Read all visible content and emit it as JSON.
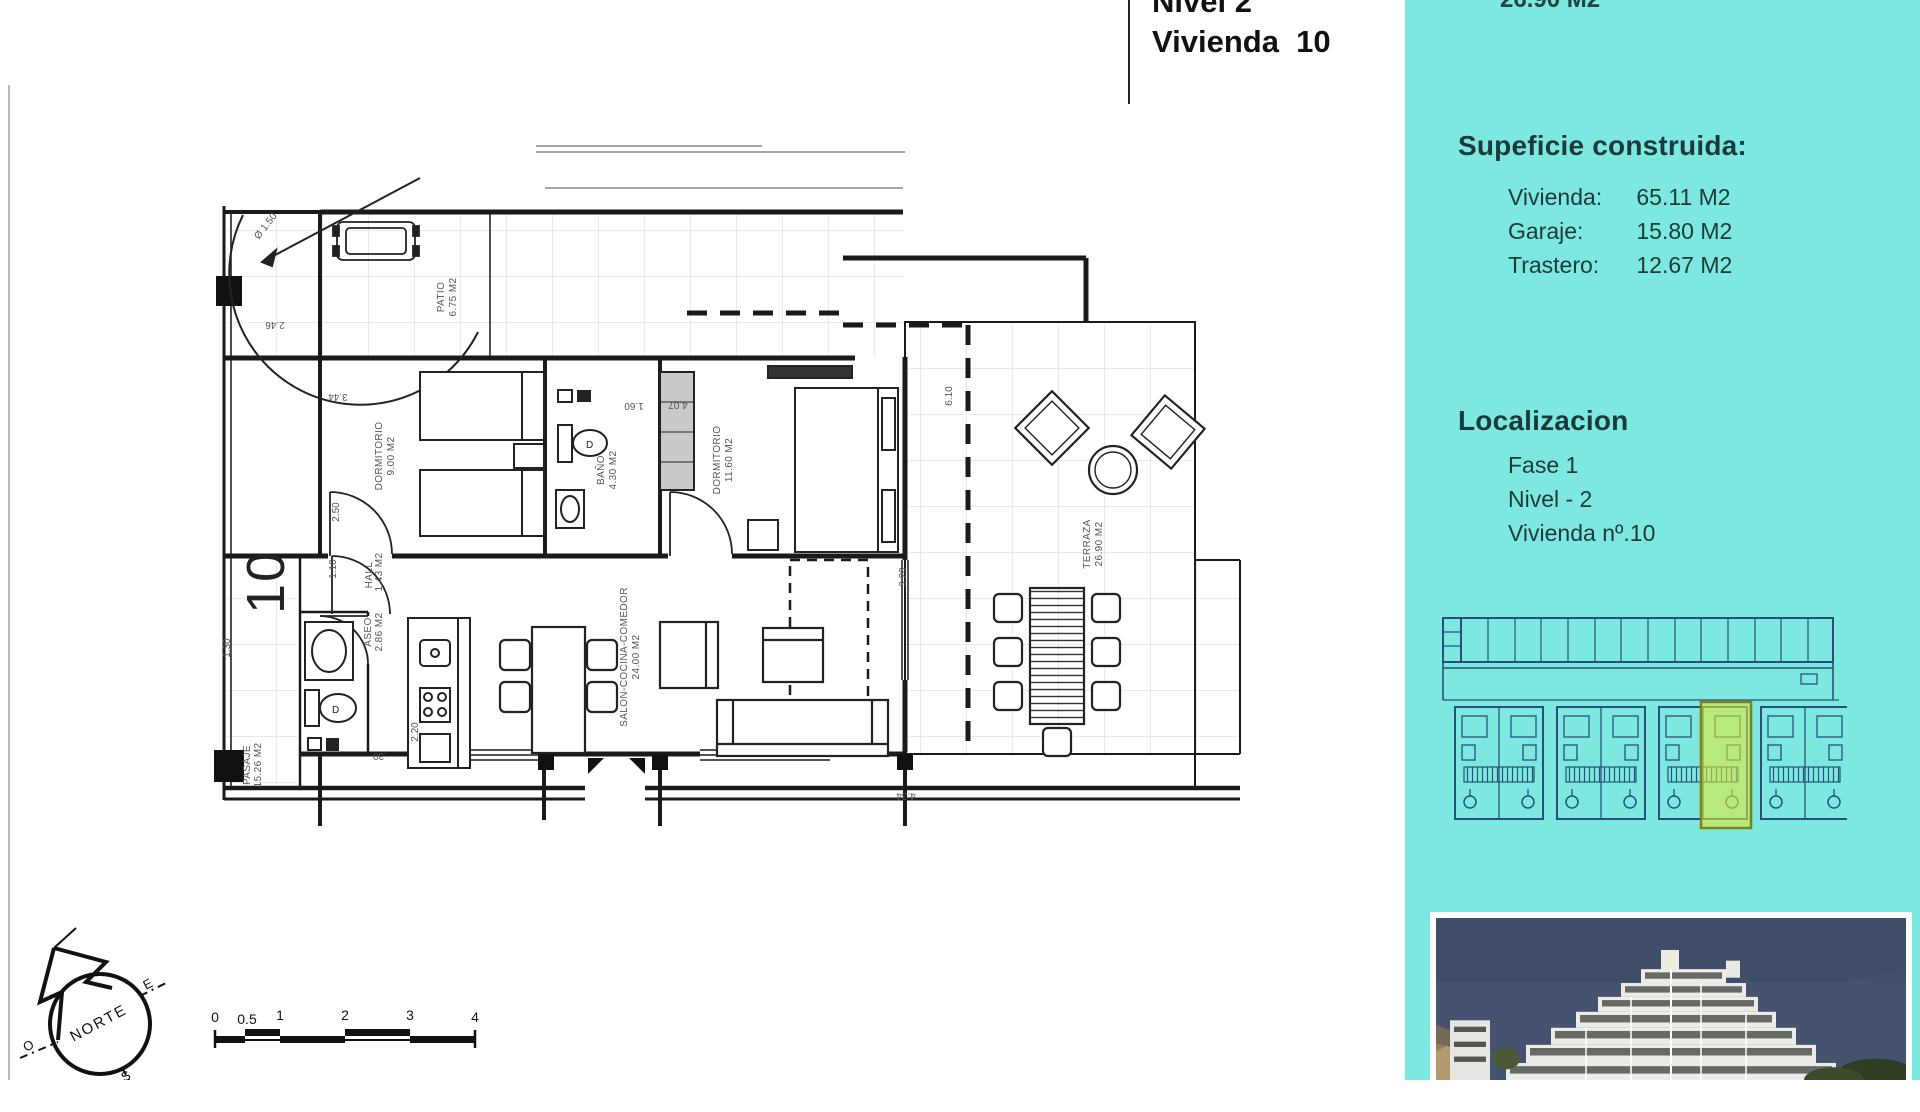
{
  "colors": {
    "sidebar_bg": "#7de8e0",
    "highlight": "#e3ea36",
    "thumb_line": "#28517a"
  },
  "header": {
    "line1": "Nivel 2",
    "line2": "Vivienda  10"
  },
  "sidebar": {
    "top_partial": "26.90 M2",
    "surface_title": "Supeficie construida:",
    "surface_rows": [
      {
        "label": "Vivienda:",
        "value": "65.11 M2"
      },
      {
        "label": "Garaje:",
        "value": "15.80 M2"
      },
      {
        "label": "Trastero:",
        "value": "12.67 M2"
      }
    ],
    "location_title": "Localizacion",
    "location_rows": [
      "Fase 1",
      "Nivel - 2",
      "Vivienda nº.10"
    ]
  },
  "plan": {
    "unit_number": "10",
    "rooms": [
      {
        "name": "PATIO",
        "area": "6.75 M2"
      },
      {
        "name": "DORMITORIO",
        "area": "9.00 M2"
      },
      {
        "name": "BAÑO",
        "area": "4.30 M2"
      },
      {
        "name": "DORMITORIO",
        "area": "11.60 M2"
      },
      {
        "name": "SALON-COCINA-COMEDOR",
        "area": "24.00 M2"
      },
      {
        "name": "ASEO",
        "area": "2.86 M2"
      },
      {
        "name": "HALL",
        "area": "1.43 M2"
      },
      {
        "name": "TERRAZA",
        "area": "26.90 M2"
      },
      {
        "name": "PASAJE",
        "area": "15.26 M2"
      }
    ],
    "dims": {
      "d344": "3.44",
      "d250": "2.50",
      "d246": "2.46",
      "d110": "1.10",
      "d130": "1.30",
      "d160": "1.60",
      "d407": "4.07",
      "d610": "6.10",
      "d320": "3.20",
      "d220": "2.20",
      "d30": ".30",
      "d434": "4.34",
      "diam": "Ø 1.50"
    },
    "compass": {
      "n": "NORTE",
      "e": "E",
      "o": "O",
      "s": "S"
    },
    "scale_ticks": [
      "0",
      "0.5",
      "1",
      "2",
      "3",
      "4"
    ]
  }
}
